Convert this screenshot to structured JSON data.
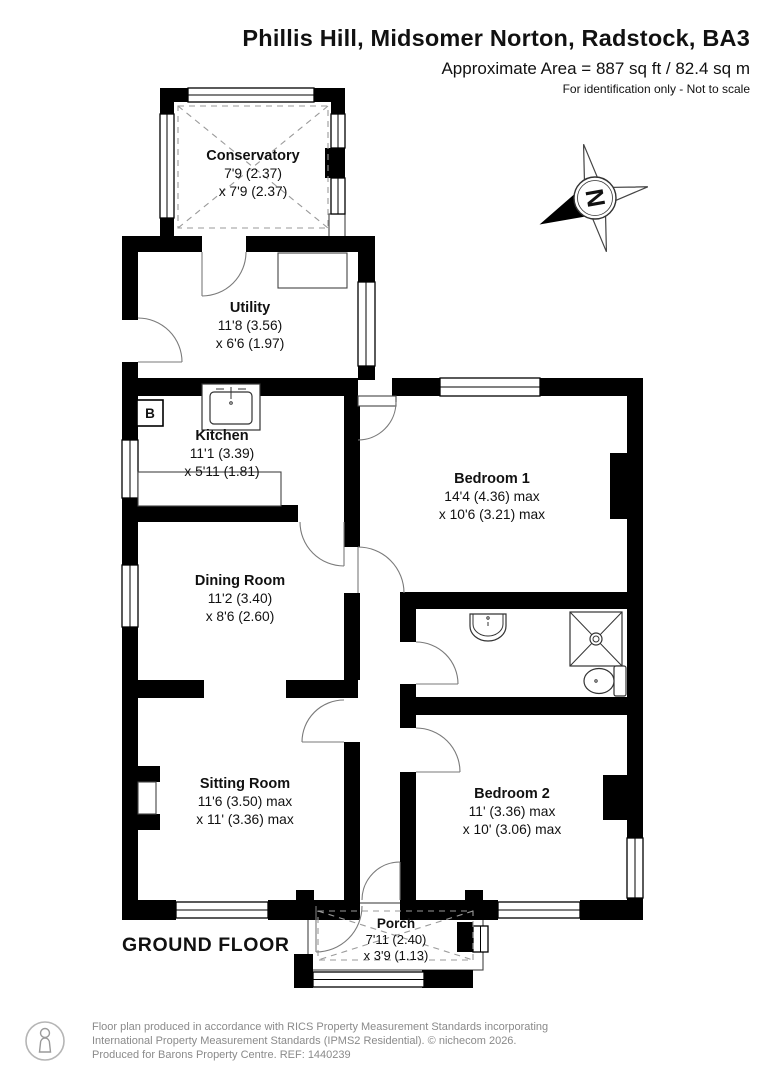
{
  "header": {
    "title": "Phillis Hill, Midsomer Norton, Radstock, BA3",
    "area_line": "Approximate Area = 887 sq ft / 82.4 sq m",
    "disclaimer": "For identification only - Not to scale"
  },
  "floor_label": "GROUND FLOOR",
  "compass": {
    "north_label": "N"
  },
  "annotations": {
    "boiler": "B"
  },
  "rooms": {
    "conservatory": {
      "name": "Conservatory",
      "dim1": "7'9 (2.37)",
      "dim2": "x 7'9 (2.37)"
    },
    "utility": {
      "name": "Utility",
      "dim1": "11'8 (3.56)",
      "dim2": "x 6'6 (1.97)"
    },
    "kitchen": {
      "name": "Kitchen",
      "dim1": "11'1 (3.39)",
      "dim2": "x 5'11 (1.81)"
    },
    "bedroom1": {
      "name": "Bedroom 1",
      "dim1": "14'4 (4.36) max",
      "dim2": "x 10'6 (3.21) max"
    },
    "dining": {
      "name": "Dining Room",
      "dim1": "11'2 (3.40)",
      "dim2": "x 8'6 (2.60)"
    },
    "sitting": {
      "name": "Sitting Room",
      "dim1": "11'6 (3.50) max",
      "dim2": "x 11' (3.36) max"
    },
    "bedroom2": {
      "name": "Bedroom 2",
      "dim1": "11' (3.36) max",
      "dim2": "x 10' (3.06) max"
    },
    "porch": {
      "name": "Porch",
      "dim1": "7'11 (2.40)",
      "dim2": "x 3'9 (1.13)"
    }
  },
  "footer": {
    "line1": "Floor plan produced in accordance with RICS Property Measurement Standards incorporating",
    "line2": "International Property Measurement Standards (IPMS2 Residential).   © nichecom 2026.",
    "line3": "Produced for Barons Property Centre.   REF: 1440239"
  },
  "colors": {
    "wall": "#000000",
    "text": "#111111",
    "footer_text": "#8a8a8a"
  }
}
